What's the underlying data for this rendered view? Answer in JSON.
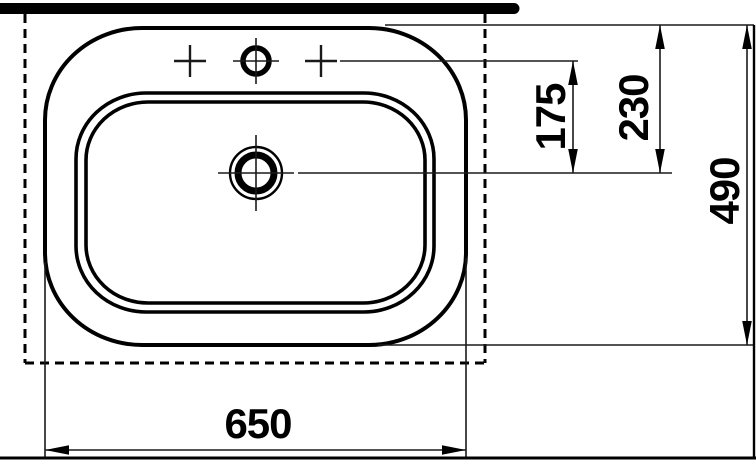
{
  "drawing": {
    "labels": {
      "width": "650",
      "depth": "490",
      "rear_to_drain": "230",
      "tap_to_drain": "175"
    },
    "colors": {
      "ink": "#000000",
      "paper": "#ffffff"
    },
    "icons": {
      "tap_hole": "crosshair-circle",
      "side_tap_marks": "plus-mark",
      "drain": "double-circle-crosshair"
    }
  }
}
